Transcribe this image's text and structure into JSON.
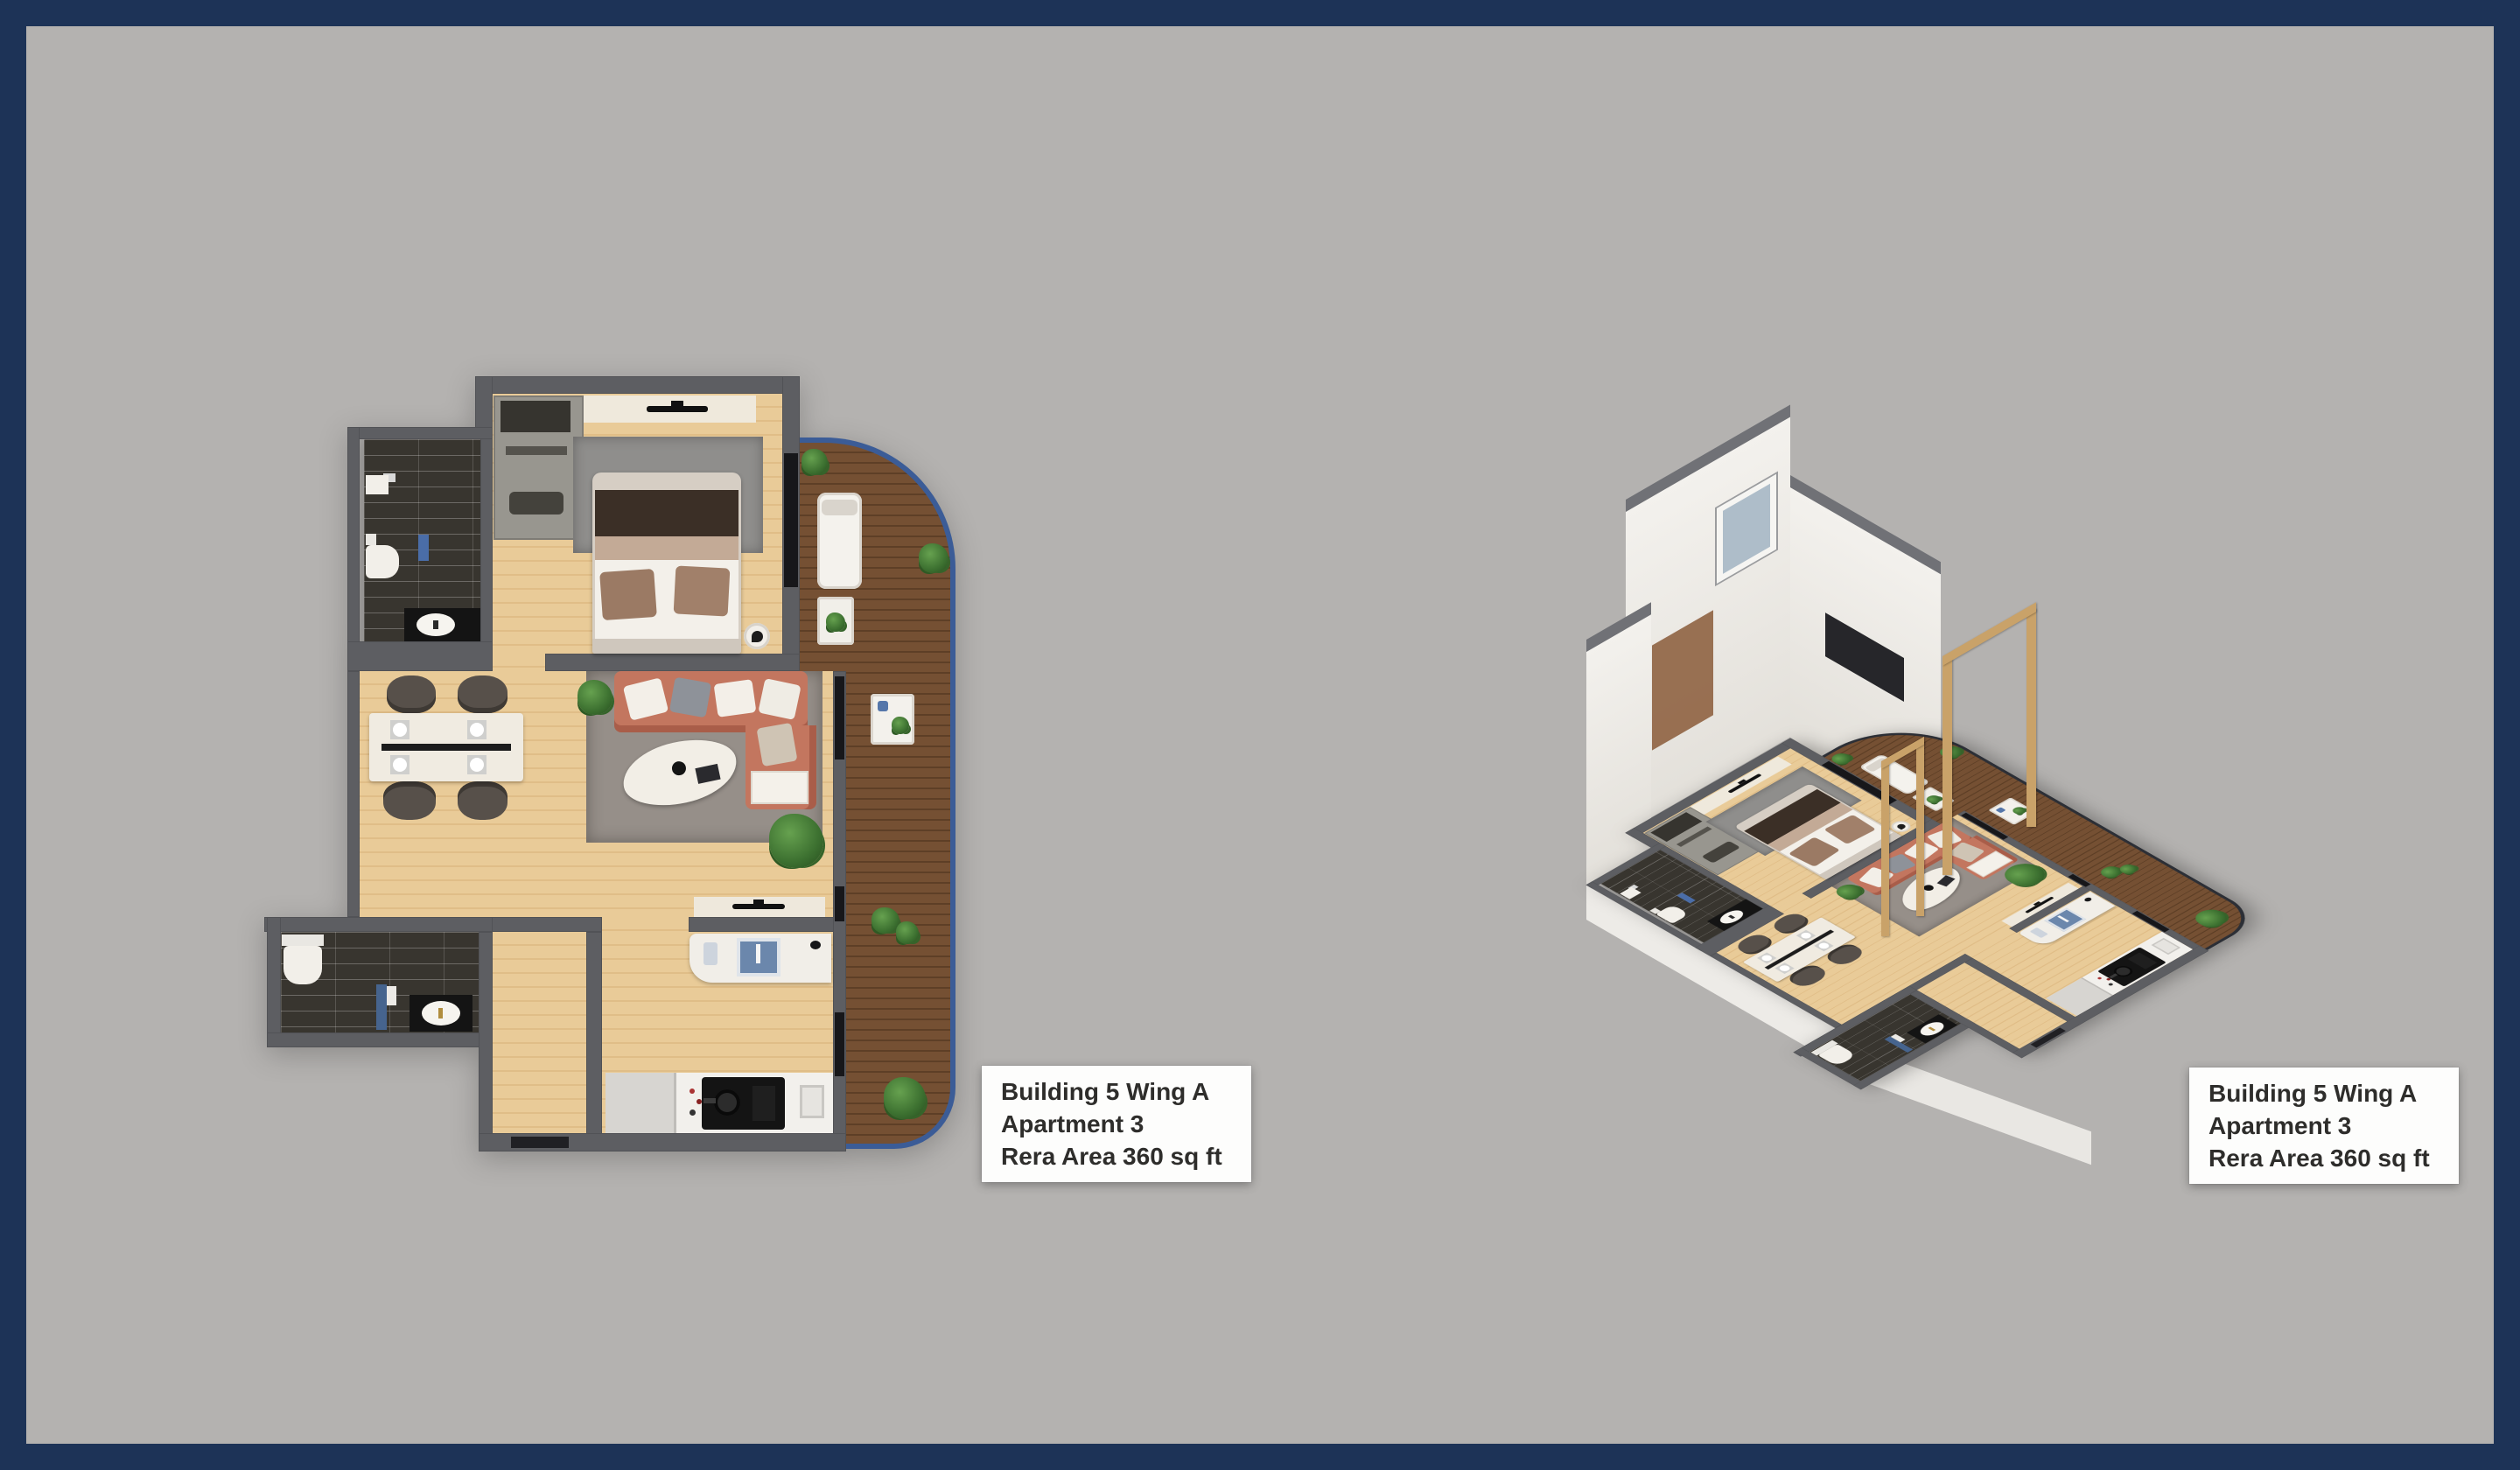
{
  "frame": {
    "border_color": "#1d3357",
    "background_color": "#b4b2b0"
  },
  "panels": {
    "left": {
      "type": "2d-top-down-floor-plan",
      "label": {
        "line1": "Building 5 Wing A",
        "line2": "Apartment 3",
        "line3": "Rera Area 360 sq ft"
      }
    },
    "right": {
      "type": "3d-isometric-floor-plan",
      "label": {
        "line1": "Building 5 Wing A",
        "line2": "Apartment 3",
        "line3": "Rera Area 360 sq ft"
      }
    }
  },
  "colors": {
    "wall": "#5d5e62",
    "wood_floor": "#e7c795",
    "deck_wood": "#6f4a2e",
    "balcony_outline_2d": "#3b5c97",
    "balcony_railing_3d": "#2c2f36",
    "bathroom_tile": "#38352f",
    "sofa": "#c3765f",
    "rug": "#968f89",
    "bed_blanket": "#3b2f26",
    "sink_blue": "#6b87ac",
    "label_background": "#fdfdfc",
    "label_text": "#2e2d2b",
    "plant_green": "#3c7030",
    "wall_cap_3d": "#707176",
    "wall_face_3d": "#f3f1ed",
    "door_frame_wood_3d": "#c9a269"
  }
}
